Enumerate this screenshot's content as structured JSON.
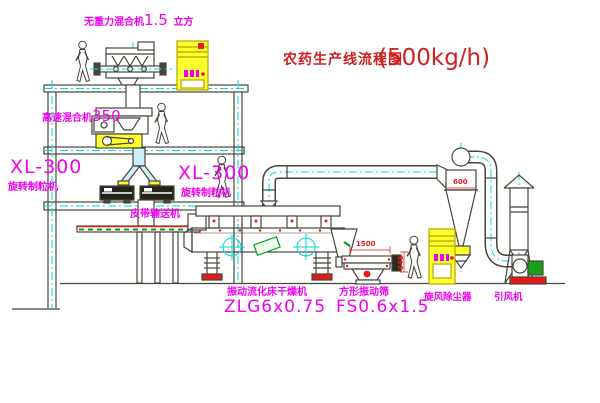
{
  "title": {
    "name": "农药生产线流程图",
    "capacity": "(500kg/h)"
  },
  "equipment_labels": {
    "gravity_mixer": {
      "name": "无重力混合机",
      "value": "1.5",
      "unit": "立方"
    },
    "high_speed_mixer": {
      "name": "高速混合机",
      "value": "350"
    },
    "granulator_left": {
      "model": "XL-300",
      "name": "旋转制粒机"
    },
    "granulator_right": {
      "model": "XL-300",
      "name": "旋转制粒机"
    },
    "belt_conveyor": {
      "name": "皮带输送机"
    },
    "fluid_bed_dryer": {
      "name": "振动流化床干燥机",
      "model": "ZLG6x0.75"
    },
    "vibrating_sieve": {
      "name": "方形振动筛",
      "model": "FS0.6x1.5"
    },
    "cyclone": {
      "name": "旋风除尘器"
    },
    "induced_draft_fan": {
      "name": "引风机"
    }
  },
  "dimensions": {
    "sieve_length": "1500",
    "sieve_height": "345",
    "cyclone_diameter": "600"
  },
  "colors": {
    "label_magenta": "#f200f2",
    "title_red": "#cc2222",
    "dimension_red": "#e81919",
    "line_ink": "#45453a",
    "centerline_cyan": "#00d8d8",
    "highlight_yellow": "#ffff30",
    "machine_green": "#00a020"
  }
}
